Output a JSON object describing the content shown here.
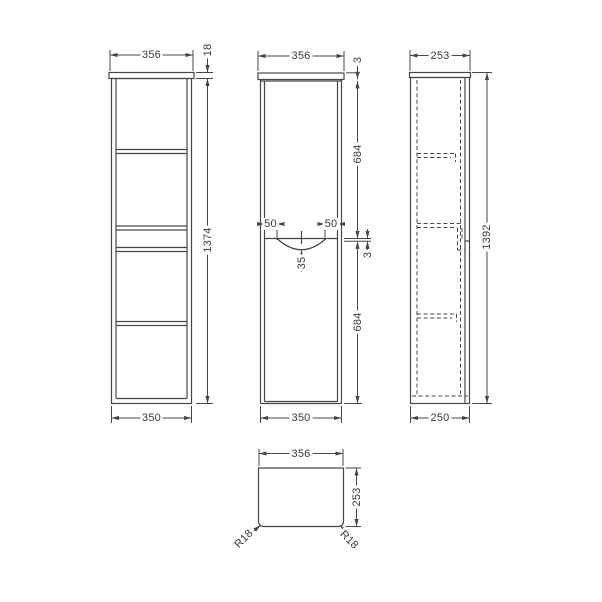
{
  "drawing": {
    "type": "technical-dimension-drawing",
    "subject": "tall wall-hung cabinet, four orthographic views",
    "units": "mm",
    "colors": {
      "line": "#474747",
      "text": "#3a3a3a",
      "background": "#ffffff"
    },
    "views": {
      "front_carcass": {
        "name": "front view (carcass with shelves)",
        "width_top": "356",
        "top_thickness": "18",
        "height": "1374",
        "width_bottom": "350"
      },
      "front_doors": {
        "name": "front view (doors)",
        "width_top": "356",
        "top_gap": "3",
        "upper_door_height": "684",
        "handle_offset_left": "50",
        "handle_offset_right": "50",
        "handle_depth": "35",
        "door_gap": "3",
        "lower_door_height": "684",
        "width_bottom": "350"
      },
      "side": {
        "name": "side view",
        "depth_top": "253",
        "height": "1392",
        "depth_bottom": "250"
      },
      "plan": {
        "name": "plan view",
        "width": "356",
        "depth": "253",
        "radius_left": "R18",
        "radius_right": "R18"
      }
    }
  }
}
